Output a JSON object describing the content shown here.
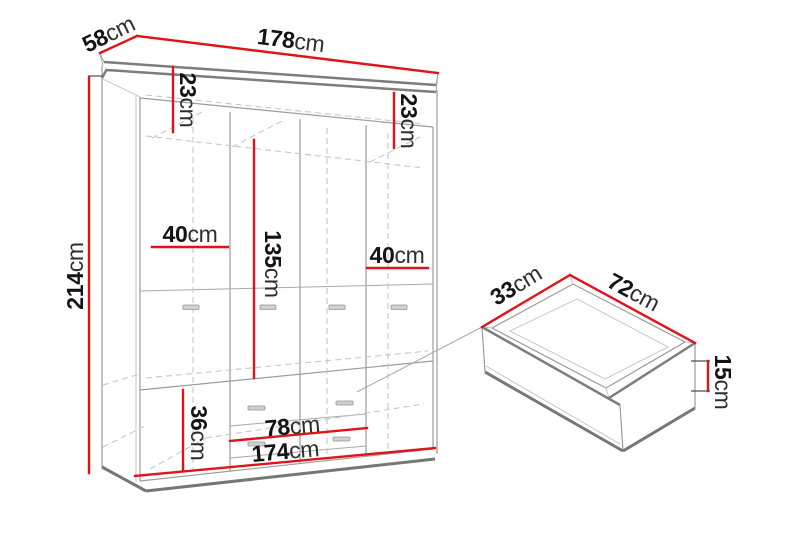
{
  "diagram": {
    "kind": "furniture-dimension-diagram",
    "colors": {
      "dimension_line_red": "#e01319",
      "outline_gray": "#9b9b9b",
      "thick_edge_gray": "#767676",
      "hidden_line_gray": "#c6c6c6",
      "text_black": "#141414",
      "background": "#ffffff"
    },
    "wardrobe": {
      "width": {
        "num": "178",
        "unit": "cm"
      },
      "depth": {
        "num": "58",
        "unit": "cm"
      },
      "height": {
        "num": "214",
        "unit": "cm"
      },
      "top_shelf_left": {
        "num": "23",
        "unit": "cm"
      },
      "top_shelf_right": {
        "num": "23",
        "unit": "cm"
      },
      "door_width_left": {
        "num": "40",
        "unit": "cm"
      },
      "door_width_right": {
        "num": "40",
        "unit": "cm"
      },
      "door_height": {
        "num": "135",
        "unit": "cm"
      },
      "drawer_section_height": {
        "num": "36",
        "unit": "cm"
      },
      "drawer_bay_width": {
        "num": "78",
        "unit": "cm"
      },
      "interior_width": {
        "num": "174",
        "unit": "cm"
      }
    },
    "drawer": {
      "depth": {
        "num": "33",
        "unit": "cm"
      },
      "width": {
        "num": "72",
        "unit": "cm"
      },
      "height": {
        "num": "15",
        "unit": "cm"
      }
    }
  }
}
